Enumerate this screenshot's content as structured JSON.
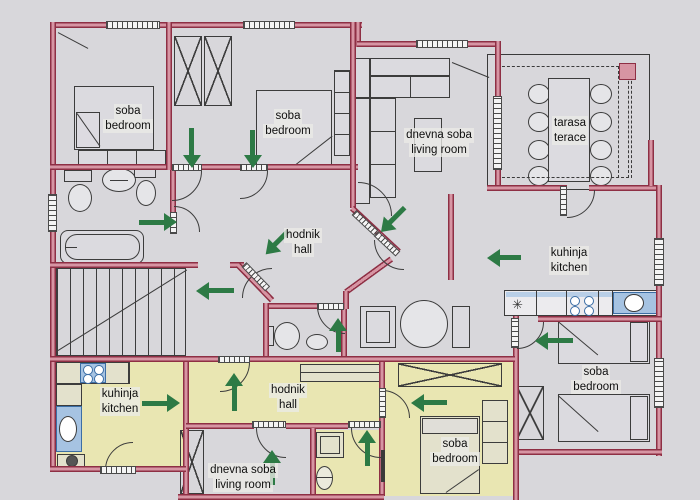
{
  "rooms": [
    {
      "name": "soba",
      "name_en": "bedroom",
      "area": "upper-left"
    },
    {
      "name": "soba",
      "name_en": "bedroom",
      "area": "upper-middle"
    },
    {
      "name": "dnevna soba",
      "name_en": "living room",
      "area": "upper-right"
    },
    {
      "name": "tarasa",
      "name_en": "terace",
      "area": "terrace"
    },
    {
      "name": "hodnik",
      "name_en": "hall",
      "area": "upper-center"
    },
    {
      "name": "kuhinja",
      "name_en": "kitchen",
      "area": "right"
    },
    {
      "name": "soba",
      "name_en": "bedroom",
      "area": "right-lower"
    },
    {
      "name": "kuhinja",
      "name_en": "kitchen",
      "area": "lower-left"
    },
    {
      "name": "hodnik",
      "name_en": "hall",
      "area": "lower-center"
    },
    {
      "name": "dnevna soba",
      "name_en": "living room",
      "area": "lower-bottom"
    },
    {
      "name": "soba",
      "name_en": "bedroom",
      "area": "lower-middle"
    }
  ],
  "arrows": [
    {
      "dir": "down",
      "left": 183,
      "top": 128,
      "len": 40
    },
    {
      "dir": "down",
      "left": 244,
      "top": 130,
      "len": 38
    },
    {
      "dir": "right",
      "left": 149,
      "top": 203,
      "len": 38
    },
    {
      "dir": "left",
      "left": 206,
      "top": 272,
      "len": 38
    },
    {
      "dir": "down-left",
      "left": 268,
      "top": 227,
      "len": 32
    },
    {
      "dir": "down-left",
      "left": 384,
      "top": 203,
      "len": 34
    },
    {
      "dir": "up",
      "left": 329,
      "top": 318,
      "len": 34
    },
    {
      "dir": "left",
      "left": 495,
      "top": 241,
      "len": 34
    },
    {
      "dir": "left",
      "left": 545,
      "top": 322,
      "len": 38
    },
    {
      "dir": "right",
      "left": 152,
      "top": 384,
      "len": 38
    },
    {
      "dir": "up",
      "left": 225,
      "top": 373,
      "len": 38
    },
    {
      "dir": "up",
      "left": 263,
      "top": 450,
      "len": 35
    },
    {
      "dir": "up",
      "left": 358,
      "top": 430,
      "len": 36
    },
    {
      "dir": "left",
      "left": 420,
      "top": 385,
      "len": 36
    }
  ],
  "colors": {
    "background": "#d8d7db",
    "wall_edge": "#8e2f44",
    "wall_fill": "#d795a3",
    "line": "#3c3c3c",
    "arrow_green": "#2d7a45",
    "highlight_yellow": "#e9e6b2",
    "fixture_blue": "#a6c3e2",
    "fixture_blue_border": "#3c6ea5"
  },
  "icons": {
    "entrance-arrow": "solid green directional arrow",
    "wardrobe": "rectangle with X cross",
    "window": "hatched strip in wall",
    "door": "quarter-circle swing arc with hatched leaf"
  }
}
